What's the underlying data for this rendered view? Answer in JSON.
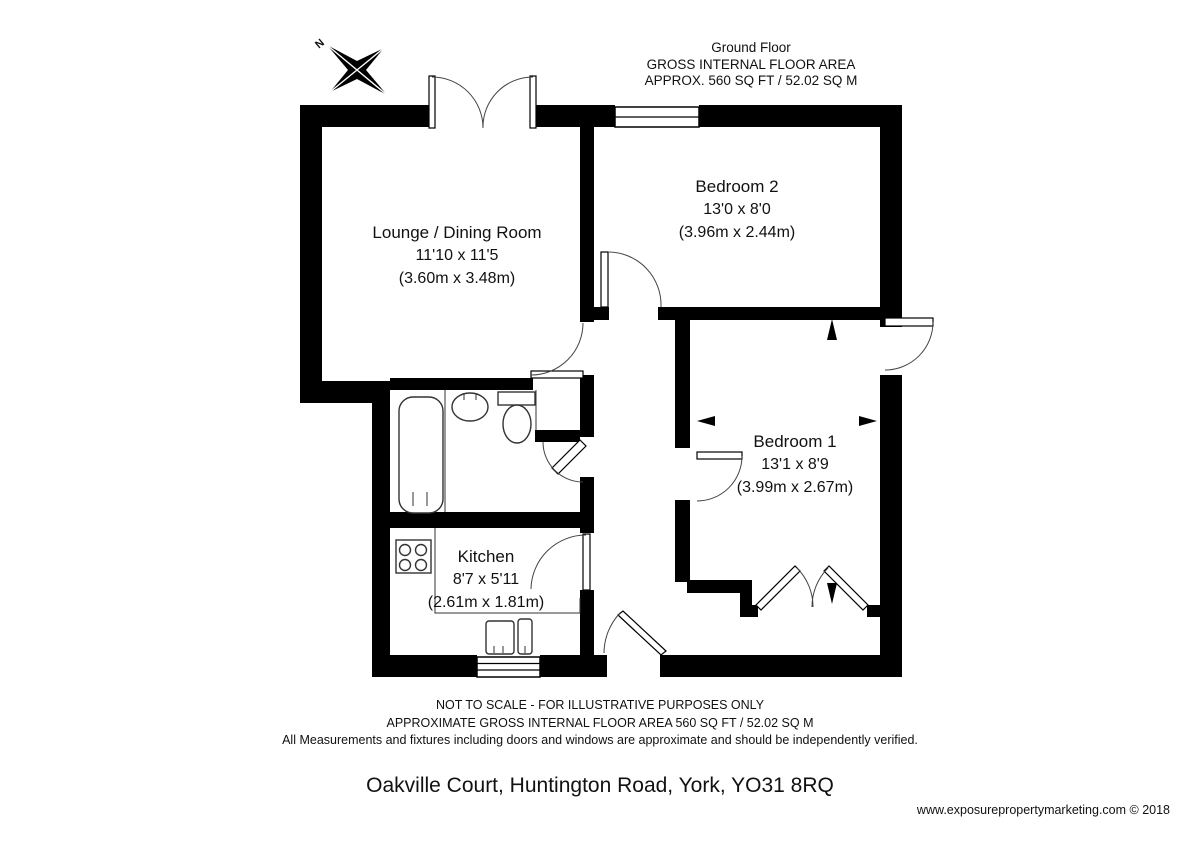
{
  "title_block": {
    "floor": "Ground Floor",
    "area_label": "GROSS INTERNAL FLOOR AREA",
    "area_value": "APPROX. 560 SQ FT / 52.02 SQ M"
  },
  "compass": {
    "label": "N"
  },
  "rooms": {
    "lounge": {
      "name": "Lounge / Dining Room",
      "imperial": "11'10 x 11'5",
      "metric": "(3.60m x 3.48m)"
    },
    "bedroom2": {
      "name": "Bedroom 2",
      "imperial": "13'0 x 8'0",
      "metric": "(3.96m x 2.44m)"
    },
    "bedroom1": {
      "name": "Bedroom 1",
      "imperial": "13'1 x 8'9",
      "metric": "(3.99m x 2.67m)"
    },
    "kitchen": {
      "name": "Kitchen",
      "imperial": "8'7 x 5'11",
      "metric": "(2.61m x 1.81m)"
    }
  },
  "disclaimer": {
    "line1": "NOT TO SCALE - FOR ILLUSTRATIVE PURPOSES ONLY",
    "line2": "APPROXIMATE GROSS INTERNAL FLOOR AREA 560 SQ FT / 52.02 SQ M",
    "line3": "All Measurements and fixtures including doors and windows are approximate and should be independently verified."
  },
  "address": "Oakville Court, Huntington Road, York, YO31 8RQ",
  "credit": "www.exposurepropertymarketing.com © 2018",
  "colors": {
    "wall": "#000000",
    "background": "#ffffff",
    "text": "#111111"
  }
}
